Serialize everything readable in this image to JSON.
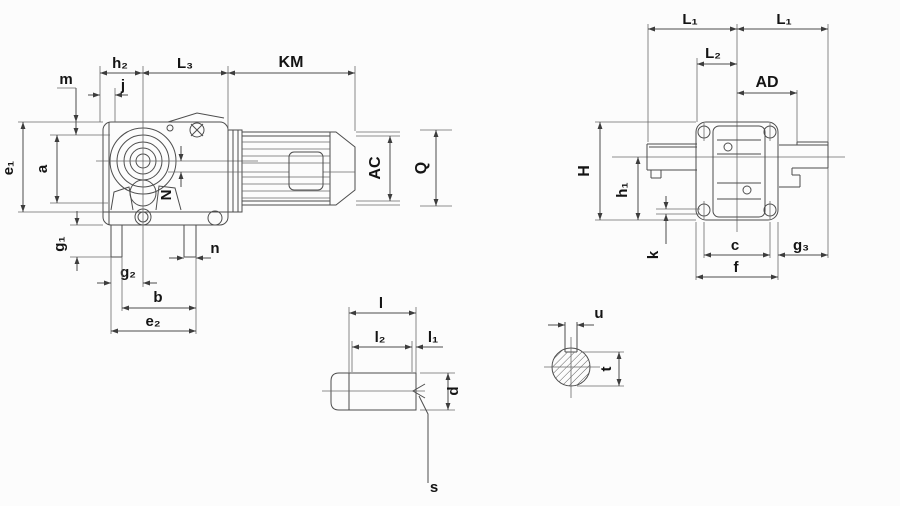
{
  "drawing": {
    "type": "engineering-dimension-diagram",
    "subject": "Helical-bevel gearmotor outline drawing with dimension symbols (side view, front view, shaft detail, keyway section)",
    "background": "#fcfcfc",
    "line_color": "#4d4d4d",
    "label_color": "#141414",
    "dims": {
      "m": "m",
      "h2": "h₂",
      "j": "j",
      "L3": "L₃",
      "KM": "KM",
      "e1": "e₁",
      "a": "a",
      "N": "N",
      "AC": "AC",
      "Q": "Q",
      "g1": "g₁",
      "n": "n",
      "g2": "g₂",
      "b": "b",
      "e2": "e₂",
      "L1_left": "L₁",
      "L1_right": "L₁",
      "L2": "L₂",
      "AD": "AD",
      "H": "H",
      "h1": "h₁",
      "k": "k",
      "c": "c",
      "f": "f",
      "g3": "g₃",
      "l": "l",
      "l2": "l₂",
      "l1": "l₁",
      "d": "d",
      "s": "s",
      "u": "u",
      "t": "t"
    },
    "views": {
      "side_view_dims": [
        "m",
        "h₂",
        "j",
        "L₃",
        "KM",
        "e₁",
        "a",
        "N",
        "AC",
        "Q",
        "g₁",
        "n",
        "g₂",
        "b",
        "e₂"
      ],
      "front_view_dims": [
        "L₁",
        "L₁",
        "L₂",
        "AD",
        "H",
        "h₁",
        "k",
        "c",
        "f",
        "g₃"
      ],
      "shaft_detail_dims": [
        "l",
        "l₂",
        "l₁",
        "d",
        "s"
      ],
      "keyway_section_dims": [
        "u",
        "t"
      ]
    }
  }
}
